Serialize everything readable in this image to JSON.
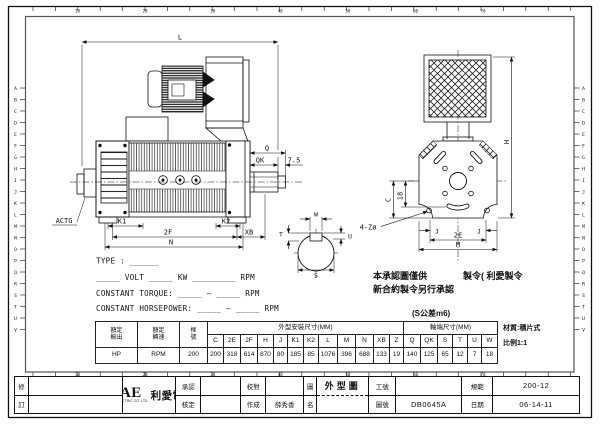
{
  "frame": {
    "row_letters": [
      "A",
      "B",
      "C",
      "D",
      "E",
      "F",
      "G",
      "H",
      "I",
      "J",
      "K",
      "L",
      "M",
      "N",
      "O",
      "P",
      "Q",
      "R",
      "S",
      "T",
      "U",
      "V"
    ],
    "col_numbers": [
      "10",
      "20",
      "30",
      "40",
      "50",
      "60",
      "70"
    ]
  },
  "side_view": {
    "dim_l": "L",
    "dim_q": "Q",
    "dim_qk": "QK",
    "dim_75": "7.5",
    "dim_k1": "K1",
    "dim_k2": "K2",
    "dim_2f": "2F",
    "dim_xb": "XB",
    "dim_n": "N",
    "tach": "ACTG"
  },
  "shaft_view": {
    "dim_w": "W",
    "dim_t": "T",
    "dim_u": "U",
    "dim_s": "S"
  },
  "end_view": {
    "dim_h": "H",
    "dim_c": "C",
    "dim_18": "18",
    "dim_holes": "4-Zø",
    "dim_j1": "J",
    "dim_j2": "J",
    "dim_2e": "2E",
    "dim_m": "M"
  },
  "spec_lines": {
    "type": "TYPE : ______",
    "volt": "_____ VOLT _____ KW _________ RPM",
    "torque": "CONSTANT TORQUE: _____ — _____ RPM",
    "horsepower": "CONSTANT HORSEPOWER: _____ — _____ RPM"
  },
  "note": {
    "line1a": "本承認圖僅供",
    "line1b": "製令( 利愛製令",
    "line2": "新合約製令另行承認",
    "tolerance": "(S公差m6)"
  },
  "table": {
    "output_h": "額定\n輸出",
    "speed_h": "額定\n轉速",
    "frame_h": "框\n號",
    "output_v": "HP",
    "speed_v": "RPM",
    "frame_v": "200",
    "mount_group": "外型安裝尺寸(MM)",
    "shaft_group": "軸端尺寸(MM)",
    "mount_cols": [
      {
        "k": "C",
        "v": "200"
      },
      {
        "k": "2E",
        "v": "318"
      },
      {
        "k": "2F",
        "v": "614"
      },
      {
        "k": "H",
        "v": "870"
      },
      {
        "k": "J",
        "v": "80"
      },
      {
        "k": "K1",
        "v": "185"
      },
      {
        "k": "K2",
        "v": "85"
      },
      {
        "k": "L",
        "v": "1076"
      },
      {
        "k": "M",
        "v": "396"
      },
      {
        "k": "N",
        "v": "688"
      },
      {
        "k": "XB",
        "v": "133"
      },
      {
        "k": "Z",
        "v": "19"
      }
    ],
    "shaft_cols": [
      {
        "k": "Q",
        "v": "140"
      },
      {
        "k": "QK",
        "v": "125"
      },
      {
        "k": "S",
        "v": "65"
      },
      {
        "k": "T",
        "v": "12"
      },
      {
        "k": "U",
        "v": "7"
      },
      {
        "k": "W",
        "v": "18"
      }
    ],
    "material": "材質:積片式",
    "scale": "比例1:1"
  },
  "title_block": {
    "rev_top": "修",
    "rev_bottom": "訂",
    "logo_main": "LAE",
    "logo_cjk": "利愛電氣",
    "logo_sub": "LI AVE ELECTRIC CO.,LTD",
    "approve": "承認",
    "ratify": "核定",
    "proof": "校對",
    "made": "作成",
    "made_value": "薛秀香",
    "name_top": "圖",
    "name_bottom": "名",
    "drawing_name": "外型圖",
    "work_no": "工號",
    "work_value": "",
    "dwg_no": "圖號",
    "dwg_value": "DB0645A",
    "spec": "規範",
    "spec_value": "200-12",
    "date": "日期",
    "date_value": "06-14-11"
  }
}
